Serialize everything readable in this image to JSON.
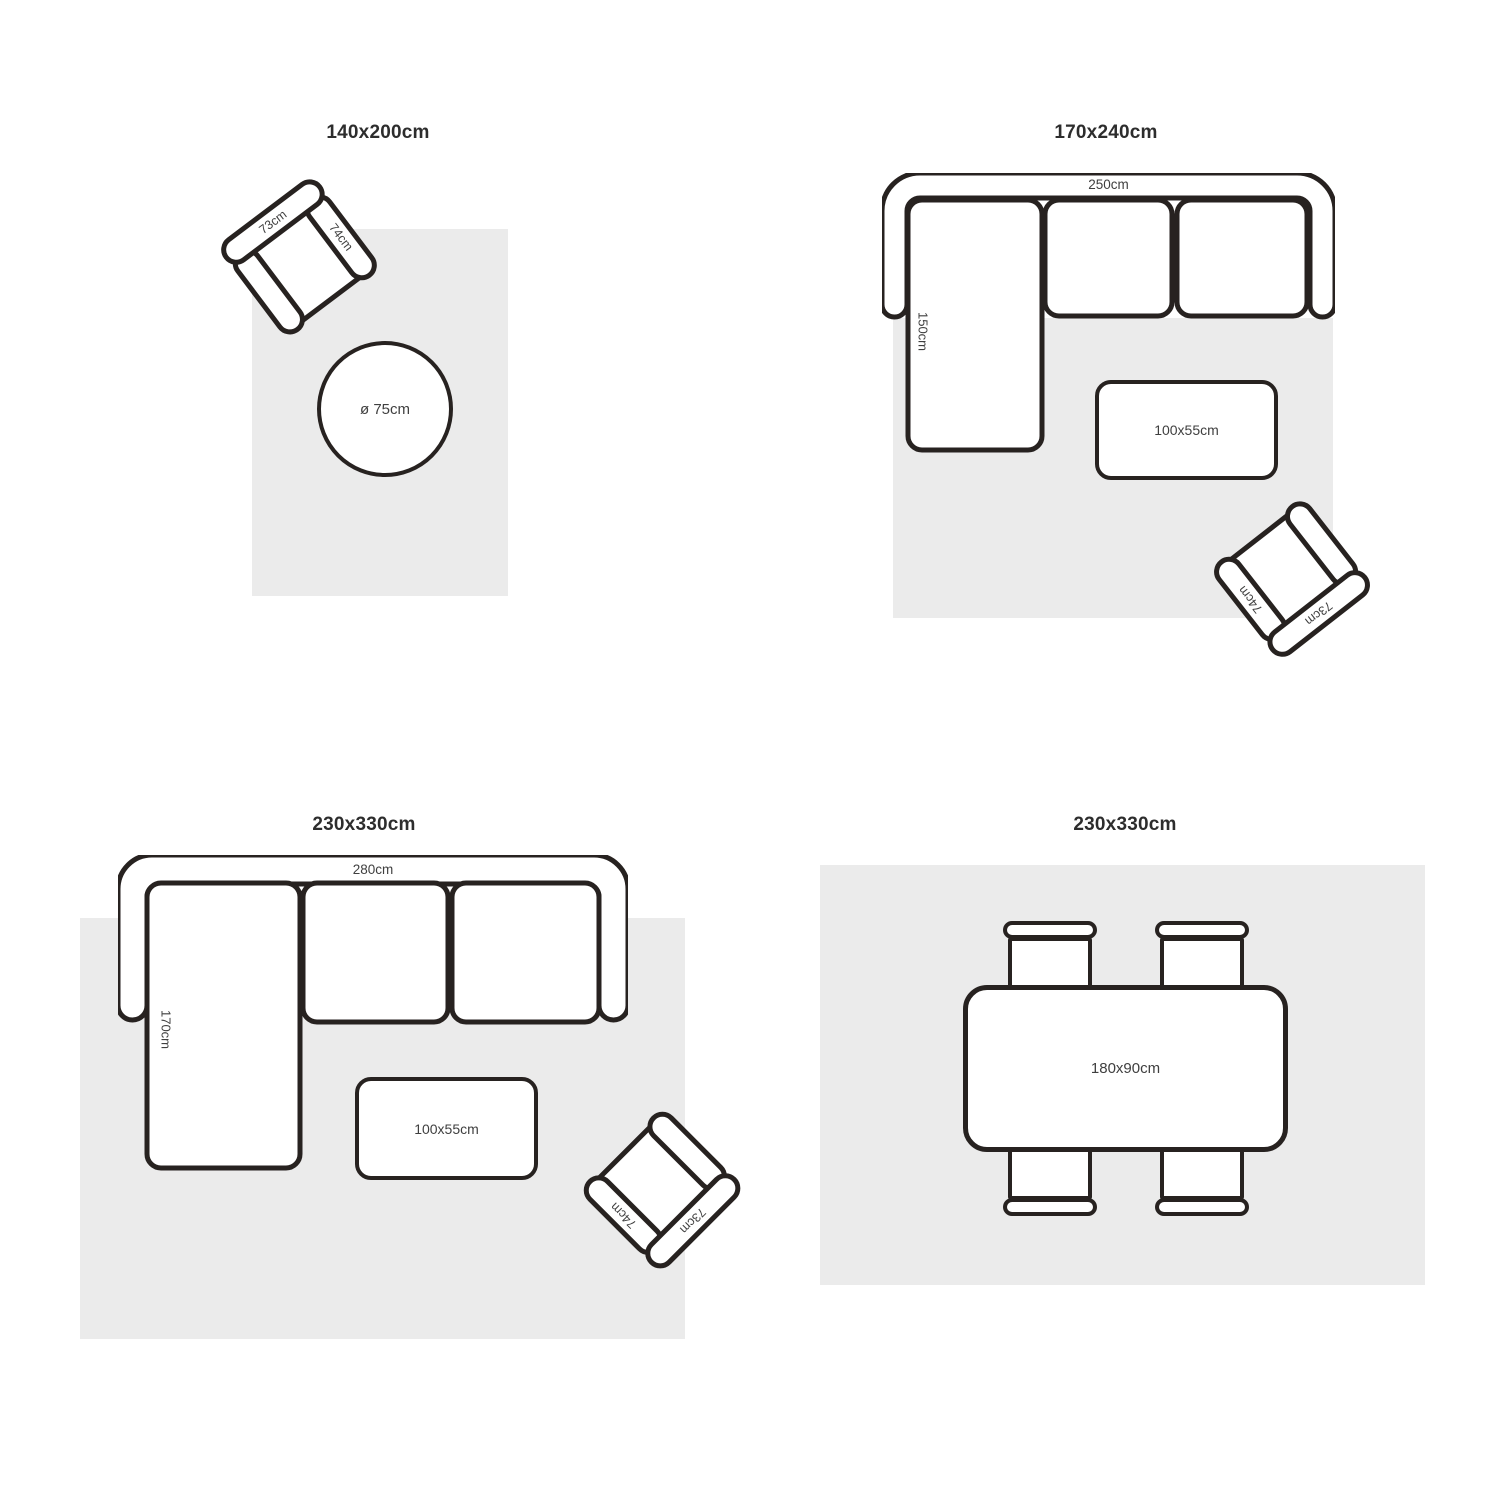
{
  "colors": {
    "line": "#272220",
    "rug": "#ebebeb",
    "title": "#2d2d2d",
    "label": "#3f3f3f"
  },
  "quadrants": [
    {
      "title": "140x200cm",
      "armchair": {
        "back": "73cm",
        "arm": "74cm"
      },
      "round_table": "ø 75cm"
    },
    {
      "title": "170x240cm",
      "sofa": {
        "width": "250cm",
        "chaise": "150cm"
      },
      "coffee_table": "100x55cm",
      "armchair": {
        "back": "73cm",
        "arm": "74cm"
      }
    },
    {
      "title": "230x330cm",
      "sofa": {
        "width": "280cm",
        "chaise": "170cm"
      },
      "coffee_table": "100x55cm",
      "armchair": {
        "back": "73cm",
        "arm": "74cm"
      }
    },
    {
      "title": "230x330cm",
      "dining_table": "180x90cm"
    }
  ]
}
